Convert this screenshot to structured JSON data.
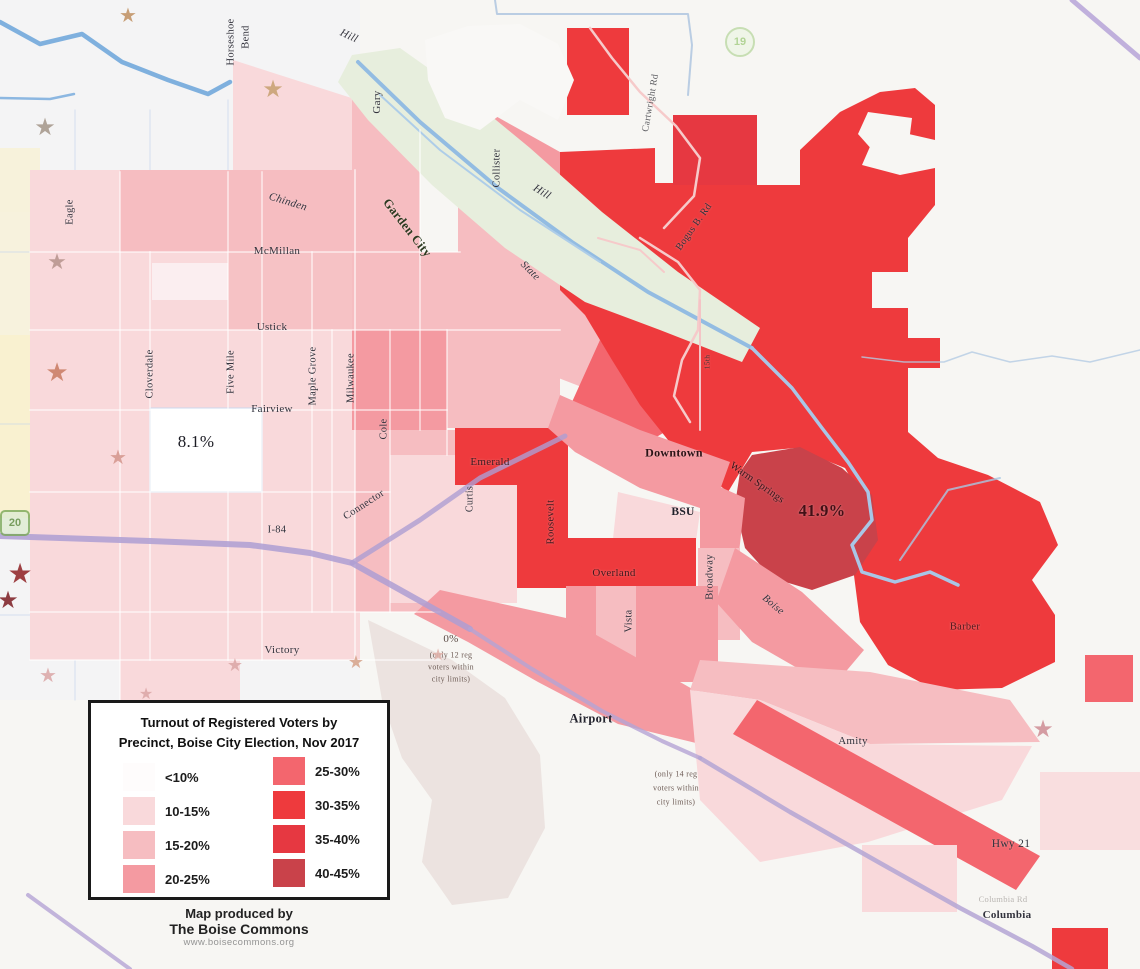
{
  "map_title_region": "Boise, Idaho voter turnout choropleth map",
  "palette": {
    "lt10": "#ffffff",
    "p10_15": "#f9d9db",
    "p15_20": "#f6bdc1",
    "p20_25": "#f49aa1",
    "p25_30": "#f3666e",
    "p30_35": "#ee3a3d",
    "p35_40": "#e63841",
    "p40_45": "#c9424a",
    "zero_grey": "#ebe2de",
    "corridor_green": "#e7eedd",
    "river_blue": "#93bce2",
    "boundary_purple": "#ae9ed2",
    "basemap_yellow": "#faf0c5"
  },
  "legend": {
    "title_lines": [
      "Turnout of Registered Voters by",
      "Precinct, Boise City Election, Nov 2017"
    ],
    "items_left": [
      {
        "label": "<10%",
        "color": "#fefcfc"
      },
      {
        "label": "10-15%",
        "color": "#f9d9db"
      },
      {
        "label": "15-20%",
        "color": "#f6bdc1"
      },
      {
        "label": "20-25%",
        "color": "#f49aa1"
      }
    ],
    "items_right": [
      {
        "label": "25-30%",
        "color": "#f3666e"
      },
      {
        "label": "30-35%",
        "color": "#ee3a3d"
      },
      {
        "label": "35-40%",
        "color": "#e63841"
      },
      {
        "label": "40-45%",
        "color": "#c9424a"
      }
    ],
    "credit": [
      "Map produced by",
      "The Boise Commons",
      "www.boisecommons.org"
    ]
  },
  "annotations": {
    "west_precinct_value": "8.1%",
    "east_precinct_value": "41.9%",
    "zero_precinct": [
      "0%",
      "(only 12 reg",
      "voters within",
      "city limits)"
    ],
    "airport_note": [
      "(only 14 reg",
      "voters within",
      "city limits)"
    ]
  },
  "map_labels": [
    {
      "text": "Horseshoe",
      "x": 231,
      "y": 42,
      "rot": -90,
      "size": 10.5
    },
    {
      "text": "Bend",
      "x": 246,
      "y": 37,
      "rot": -90,
      "size": 10.5
    },
    {
      "text": "Hill",
      "x": 349,
      "y": 36,
      "rot": 25,
      "size": 11,
      "i": 1
    },
    {
      "text": "Gary",
      "x": 377,
      "y": 102,
      "rot": -90,
      "size": 11
    },
    {
      "text": "Collister",
      "x": 497,
      "y": 168,
      "rot": -90,
      "size": 10.5
    },
    {
      "text": "Hill",
      "x": 542,
      "y": 192,
      "rot": 32,
      "size": 11,
      "i": 1
    },
    {
      "text": "State",
      "x": 530,
      "y": 271,
      "rot": 45,
      "size": 10.5,
      "i": 1
    },
    {
      "text": "Garden City",
      "x": 407,
      "y": 228,
      "rot": 52,
      "size": 12.5,
      "w": 700,
      "c": "#2c3a20"
    },
    {
      "text": "Chinden",
      "x": 288,
      "y": 202,
      "rot": 17,
      "size": 11,
      "i": 1
    },
    {
      "text": "McMillan",
      "x": 277,
      "y": 251,
      "size": 11
    },
    {
      "text": "Ustick",
      "x": 272,
      "y": 327,
      "size": 11
    },
    {
      "text": "Eagle",
      "x": 70,
      "y": 212,
      "rot": -90,
      "size": 10.5
    },
    {
      "text": "Cloverdale",
      "x": 150,
      "y": 374,
      "rot": -90,
      "size": 10.5
    },
    {
      "text": "Five Mile",
      "x": 231,
      "y": 372,
      "rot": -90,
      "size": 10.5
    },
    {
      "text": "Maple Grove",
      "x": 313,
      "y": 376,
      "rot": -90,
      "size": 10.5
    },
    {
      "text": "Milwaukee",
      "x": 351,
      "y": 378,
      "rot": -90,
      "size": 10.5
    },
    {
      "text": "Cole",
      "x": 384,
      "y": 429,
      "rot": -90,
      "size": 10.5
    },
    {
      "text": "Fairview",
      "x": 272,
      "y": 409,
      "size": 11
    },
    {
      "text": "8.1%",
      "x": 196,
      "y": 442,
      "size": 17,
      "c": "#1c1c24"
    },
    {
      "text": "Emerald",
      "x": 490,
      "y": 462,
      "size": 11,
      "c": "#3a1d22"
    },
    {
      "text": "Connector",
      "x": 364,
      "y": 505,
      "rot": -33,
      "size": 10.5
    },
    {
      "text": "I-84",
      "x": 277,
      "y": 530,
      "size": 10.5
    },
    {
      "text": "Curtis",
      "x": 470,
      "y": 499,
      "rot": -90,
      "size": 10
    },
    {
      "text": "Roosevelt",
      "x": 551,
      "y": 522,
      "rot": -90,
      "size": 10.5,
      "c": "#3f1b20"
    },
    {
      "text": "Downtown",
      "x": 674,
      "y": 453,
      "size": 12,
      "w": 700,
      "c": "#2a1316"
    },
    {
      "text": "Warm Springs",
      "x": 757,
      "y": 483,
      "rot": 35,
      "size": 10.5,
      "c": "#33151b"
    },
    {
      "text": "41.9%",
      "x": 822,
      "y": 511,
      "size": 16.5,
      "w": 700,
      "c": "#431016"
    },
    {
      "text": "BSU",
      "x": 683,
      "y": 512,
      "size": 11.5,
      "w": 700,
      "c": "#20202a"
    },
    {
      "text": "Broadway",
      "x": 710,
      "y": 577,
      "rot": -90,
      "size": 10.5
    },
    {
      "text": "Overland",
      "x": 614,
      "y": 573,
      "size": 11,
      "c": "#3f191d"
    },
    {
      "text": "Vista",
      "x": 629,
      "y": 621,
      "rot": -90,
      "size": 10.5
    },
    {
      "text": "Boise",
      "x": 773,
      "y": 605,
      "rot": 40,
      "size": 10.5,
      "i": 1
    },
    {
      "text": "Victory",
      "x": 282,
      "y": 650,
      "size": 11
    },
    {
      "text": "0%",
      "x": 451,
      "y": 639,
      "size": 11,
      "c": "#5c4c46"
    },
    {
      "text": "(only 12 reg",
      "x": 451,
      "y": 655,
      "size": 8,
      "c": "#6e5c55"
    },
    {
      "text": "voters within",
      "x": 451,
      "y": 667,
      "size": 8,
      "c": "#6e5c55"
    },
    {
      "text": "city limits)",
      "x": 451,
      "y": 679,
      "size": 8,
      "c": "#6e5c55"
    },
    {
      "text": "Airport",
      "x": 591,
      "y": 719,
      "size": 12.5,
      "w": 700,
      "c": "#23232d"
    },
    {
      "text": "(only 14 reg",
      "x": 676,
      "y": 774,
      "size": 8,
      "c": "#6e5c55"
    },
    {
      "text": "voters within",
      "x": 676,
      "y": 788,
      "size": 8,
      "c": "#6e5c55"
    },
    {
      "text": "city limits)",
      "x": 676,
      "y": 802,
      "size": 8,
      "c": "#6e5c55"
    },
    {
      "text": "Amity",
      "x": 853,
      "y": 741,
      "size": 11
    },
    {
      "text": "Barber",
      "x": 965,
      "y": 627,
      "size": 10.5,
      "c": "#4c181c"
    },
    {
      "text": "Hwy 21",
      "x": 1011,
      "y": 844,
      "size": 11.5
    },
    {
      "text": "Columbia Rd",
      "x": 1003,
      "y": 899,
      "size": 8.5,
      "c": "#b9b5b1"
    },
    {
      "text": "Columbia",
      "x": 1007,
      "y": 915,
      "size": 11,
      "w": 600
    },
    {
      "text": "Bogus B. Rd",
      "x": 694,
      "y": 227,
      "rot": -55,
      "size": 10
    },
    {
      "text": "Cartwright Rd",
      "x": 651,
      "y": 103,
      "rot": -80,
      "size": 9.5,
      "c": "#5c5c60"
    },
    {
      "text": "15th",
      "x": 707,
      "y": 362,
      "rot": -90,
      "size": 7.5,
      "c": "#443333"
    }
  ],
  "stars": [
    {
      "x": 128,
      "y": 16,
      "color": "#c09060",
      "size": 20
    },
    {
      "x": 45,
      "y": 128,
      "color": "#a39588",
      "size": 24
    },
    {
      "x": 273,
      "y": 90,
      "color": "#c7a070",
      "size": 24
    },
    {
      "x": 57,
      "y": 262,
      "color": "#b5938c",
      "size": 22
    },
    {
      "x": 57,
      "y": 373,
      "color": "#c87b62",
      "size": 26
    },
    {
      "x": 118,
      "y": 458,
      "color": "#d4958c",
      "size": 20
    },
    {
      "x": 20,
      "y": 575,
      "color": "#8e2124",
      "size": 28
    },
    {
      "x": 8,
      "y": 601,
      "color": "#7c1c22",
      "size": 24
    },
    {
      "x": 48,
      "y": 676,
      "color": "#dba6a6",
      "size": 20
    },
    {
      "x": 146,
      "y": 695,
      "color": "#dba6a6",
      "size": 16
    },
    {
      "x": 235,
      "y": 665,
      "color": "#dba6a6",
      "size": 18
    },
    {
      "x": 356,
      "y": 662,
      "color": "#d6a28a",
      "size": 18
    },
    {
      "x": 438,
      "y": 656,
      "color": "#e2b2aa",
      "size": 16
    },
    {
      "x": 1043,
      "y": 730,
      "color": "#cf8d94",
      "size": 24
    }
  ],
  "shields": [
    {
      "label": "20",
      "shape": "rounded",
      "x": 0,
      "y": 510,
      "color": "#5a8838",
      "bg": "#deecd2",
      "border": "#7aa858"
    },
    {
      "label": "19",
      "shape": "circle",
      "x": 725,
      "y": 27,
      "color": "#a2cc80",
      "bg": "#eef5e6",
      "border": "#bcd9a4"
    }
  ]
}
